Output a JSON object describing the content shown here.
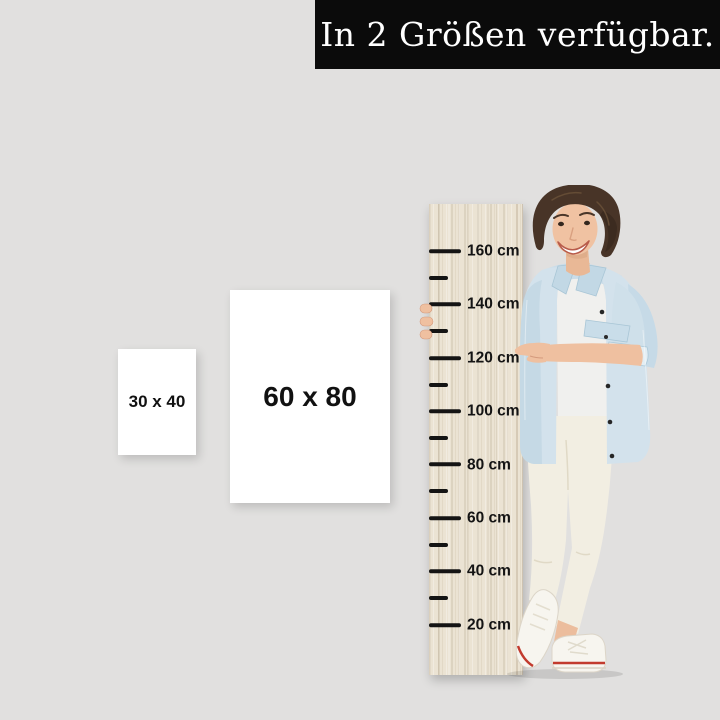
{
  "banner": {
    "text": "In 2 Größen verfügbar.",
    "bg_color": "#0b0b0b",
    "text_color": "#ffffff"
  },
  "size_options": [
    {
      "label": "30 x 40"
    },
    {
      "label": "60 x 80"
    }
  ],
  "growth_chart": {
    "unit": "cm",
    "tick_color": "#141414",
    "wood_color": "#ebe3d3",
    "ticks": [
      {
        "cm": 160,
        "label": "160 cm",
        "major": true
      },
      {
        "cm": 150,
        "label": "",
        "major": false
      },
      {
        "cm": 140,
        "label": "140 cm",
        "major": true
      },
      {
        "cm": 130,
        "label": "",
        "major": false
      },
      {
        "cm": 120,
        "label": "120 cm",
        "major": true
      },
      {
        "cm": 110,
        "label": "",
        "major": false
      },
      {
        "cm": 100,
        "label": "100 cm",
        "major": true
      },
      {
        "cm": 90,
        "label": "",
        "major": false
      },
      {
        "cm": 80,
        "label": "80 cm",
        "major": true
      },
      {
        "cm": 70,
        "label": "",
        "major": false
      },
      {
        "cm": 60,
        "label": "60 cm",
        "major": true
      },
      {
        "cm": 50,
        "label": "",
        "major": false
      },
      {
        "cm": 40,
        "label": "40 cm",
        "major": true
      },
      {
        "cm": 30,
        "label": "",
        "major": false
      },
      {
        "cm": 20,
        "label": "20 cm",
        "major": true
      }
    ]
  },
  "colors": {
    "background": "#e1e0df",
    "card_bg": "#ffffff",
    "label_color": "#111111",
    "denim_jacket": "#d3e2ec",
    "shoe_stripe": "#c23b2e"
  }
}
